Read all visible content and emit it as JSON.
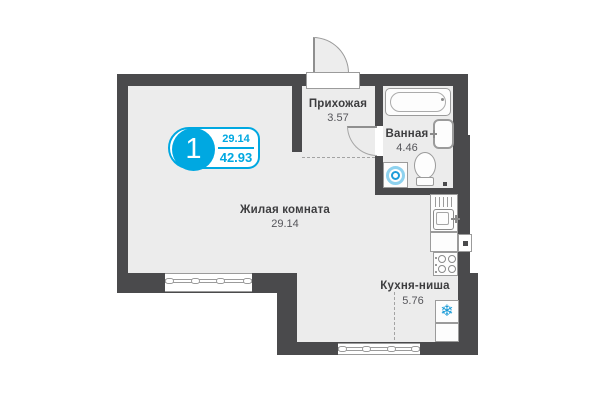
{
  "plan": {
    "type": "floor-plan",
    "badge": {
      "rooms_count": "1",
      "living_area": "29.14",
      "total_area": "42.93"
    },
    "rooms": [
      {
        "id": "hallway",
        "name": "Прихожая",
        "area": "3.57"
      },
      {
        "id": "bathroom",
        "name": "Ванная",
        "area": "4.46"
      },
      {
        "id": "living",
        "name": "Жилая комната",
        "area": "29.14"
      },
      {
        "id": "kitchen",
        "name": "Кухня-ниша",
        "area": "5.76"
      }
    ],
    "icons": {
      "snowflake": "❄"
    },
    "colors": {
      "wall": "#4a4a4c",
      "floor": "#ececec",
      "accent_blue": "#00a8e1",
      "fixture_border": "#9b9b9b",
      "snowflake_blue": "#1a9bd7",
      "washer_ring_outer": "#8ed2ef",
      "washer_ring_inner": "#1d9cd9"
    }
  }
}
